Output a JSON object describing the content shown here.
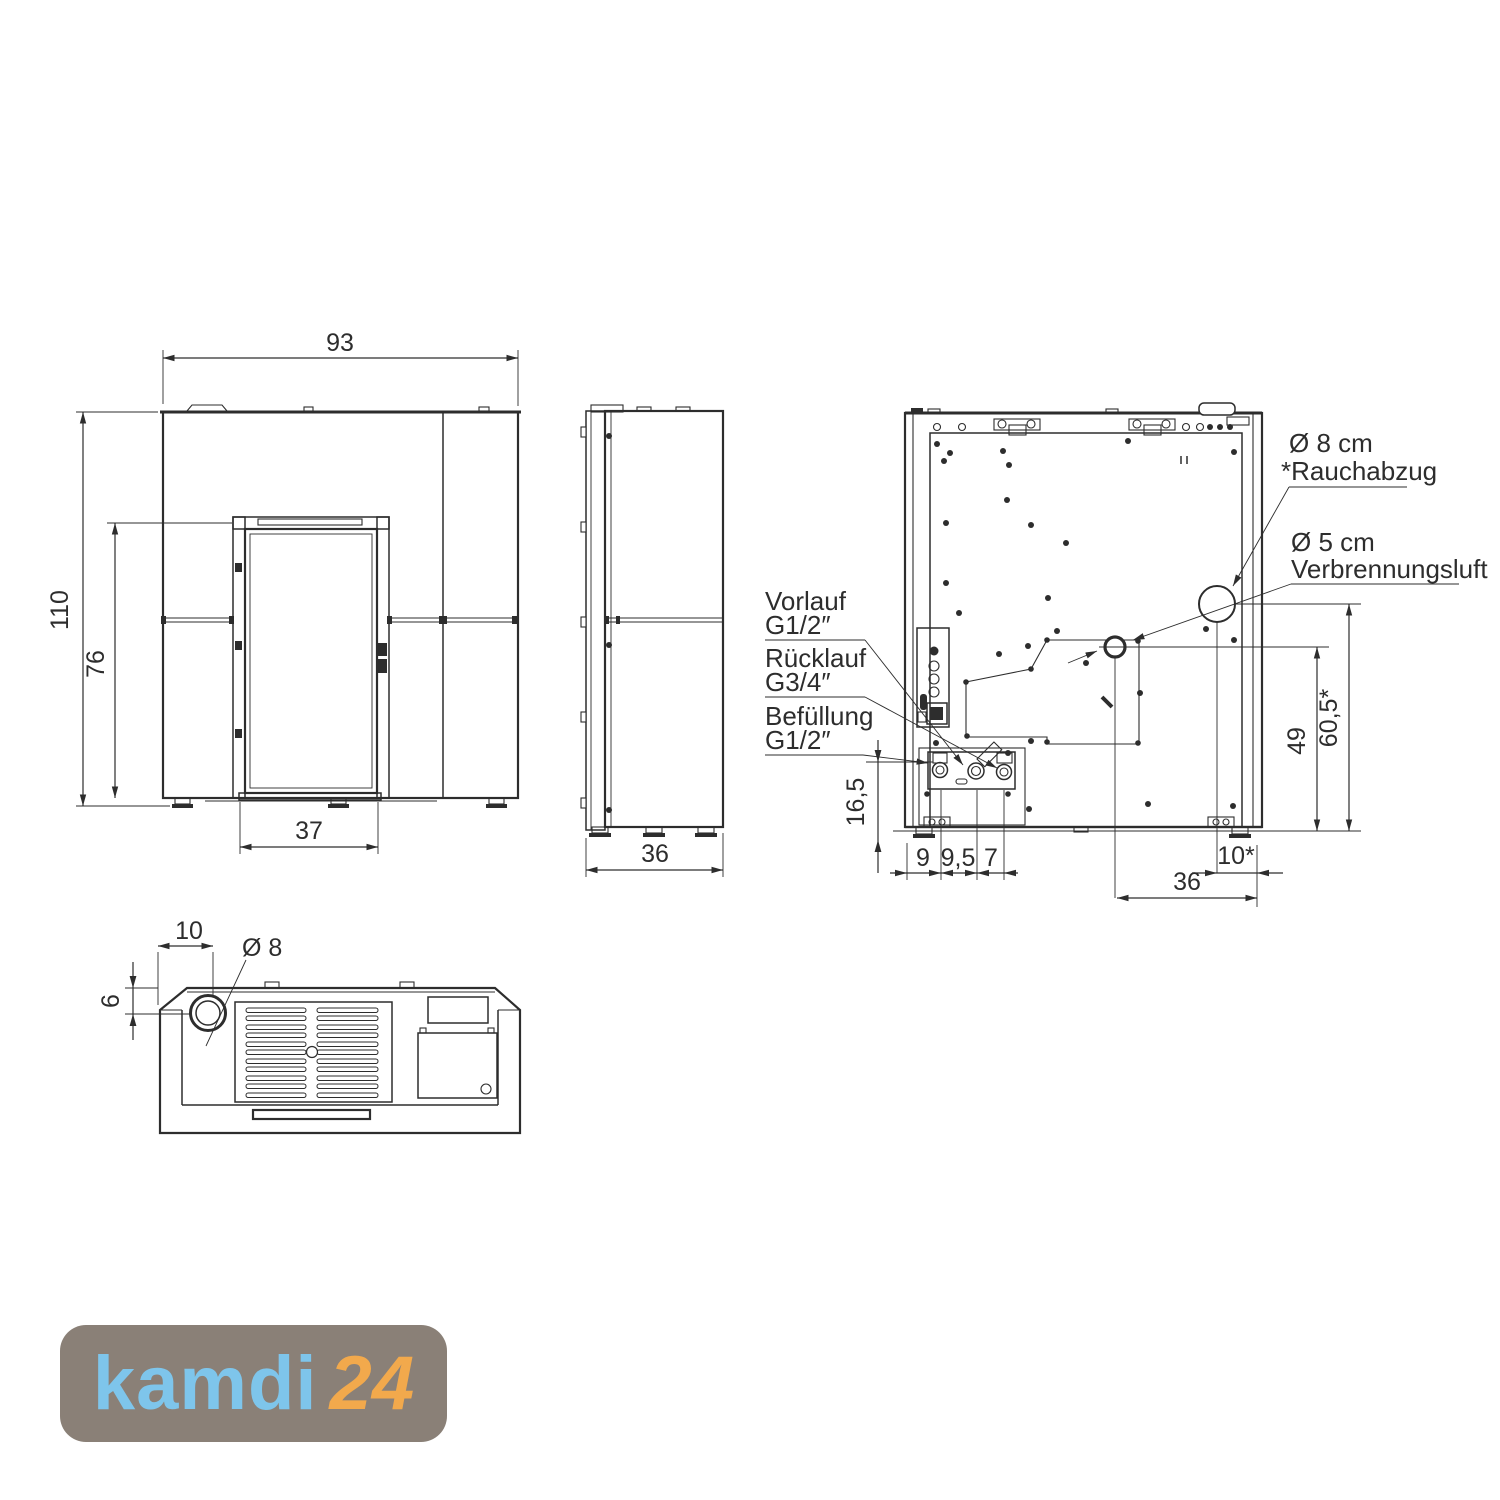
{
  "colors": {
    "line": "#2d2d2d",
    "logo_background": "#8A8077",
    "logo_main": "#7EC5EB",
    "logo_suffix": "#F2A94C"
  },
  "front_view": {
    "dim_width": "93",
    "dim_height": "110",
    "dim_door_height": "76",
    "dim_door_width": "37"
  },
  "side_view": {
    "dim_depth": "36"
  },
  "rear_view": {
    "callout_flue_diameter": "Ø 8 cm",
    "callout_flue_name": "*Rauchabzug",
    "callout_air_diameter": "Ø 5 cm",
    "callout_air_name": "Verbrennungsluft",
    "callout_supply_name": "Vorlauf",
    "callout_supply_size": "G1/2″",
    "callout_return_name": "Rücklauf",
    "callout_return_size": "G3/4″",
    "callout_fill_name": "Befüllung",
    "callout_fill_size": "G1/2″",
    "dim_connection_height": "16,5",
    "dim_fill_offset": "9",
    "dim_return_offset": "9,5",
    "dim_supply_offset": "7",
    "dim_flue_to_edge": "10*",
    "dim_air_to_edge": "36",
    "dim_air_height": "49",
    "dim_flue_height": "60,5*"
  },
  "top_view": {
    "dim_flue_offset": "10",
    "dim_flue_diameter": "Ø 8",
    "dim_flue_depth": "6"
  },
  "logo": {
    "main": "kamdi",
    "suffix": "24"
  }
}
